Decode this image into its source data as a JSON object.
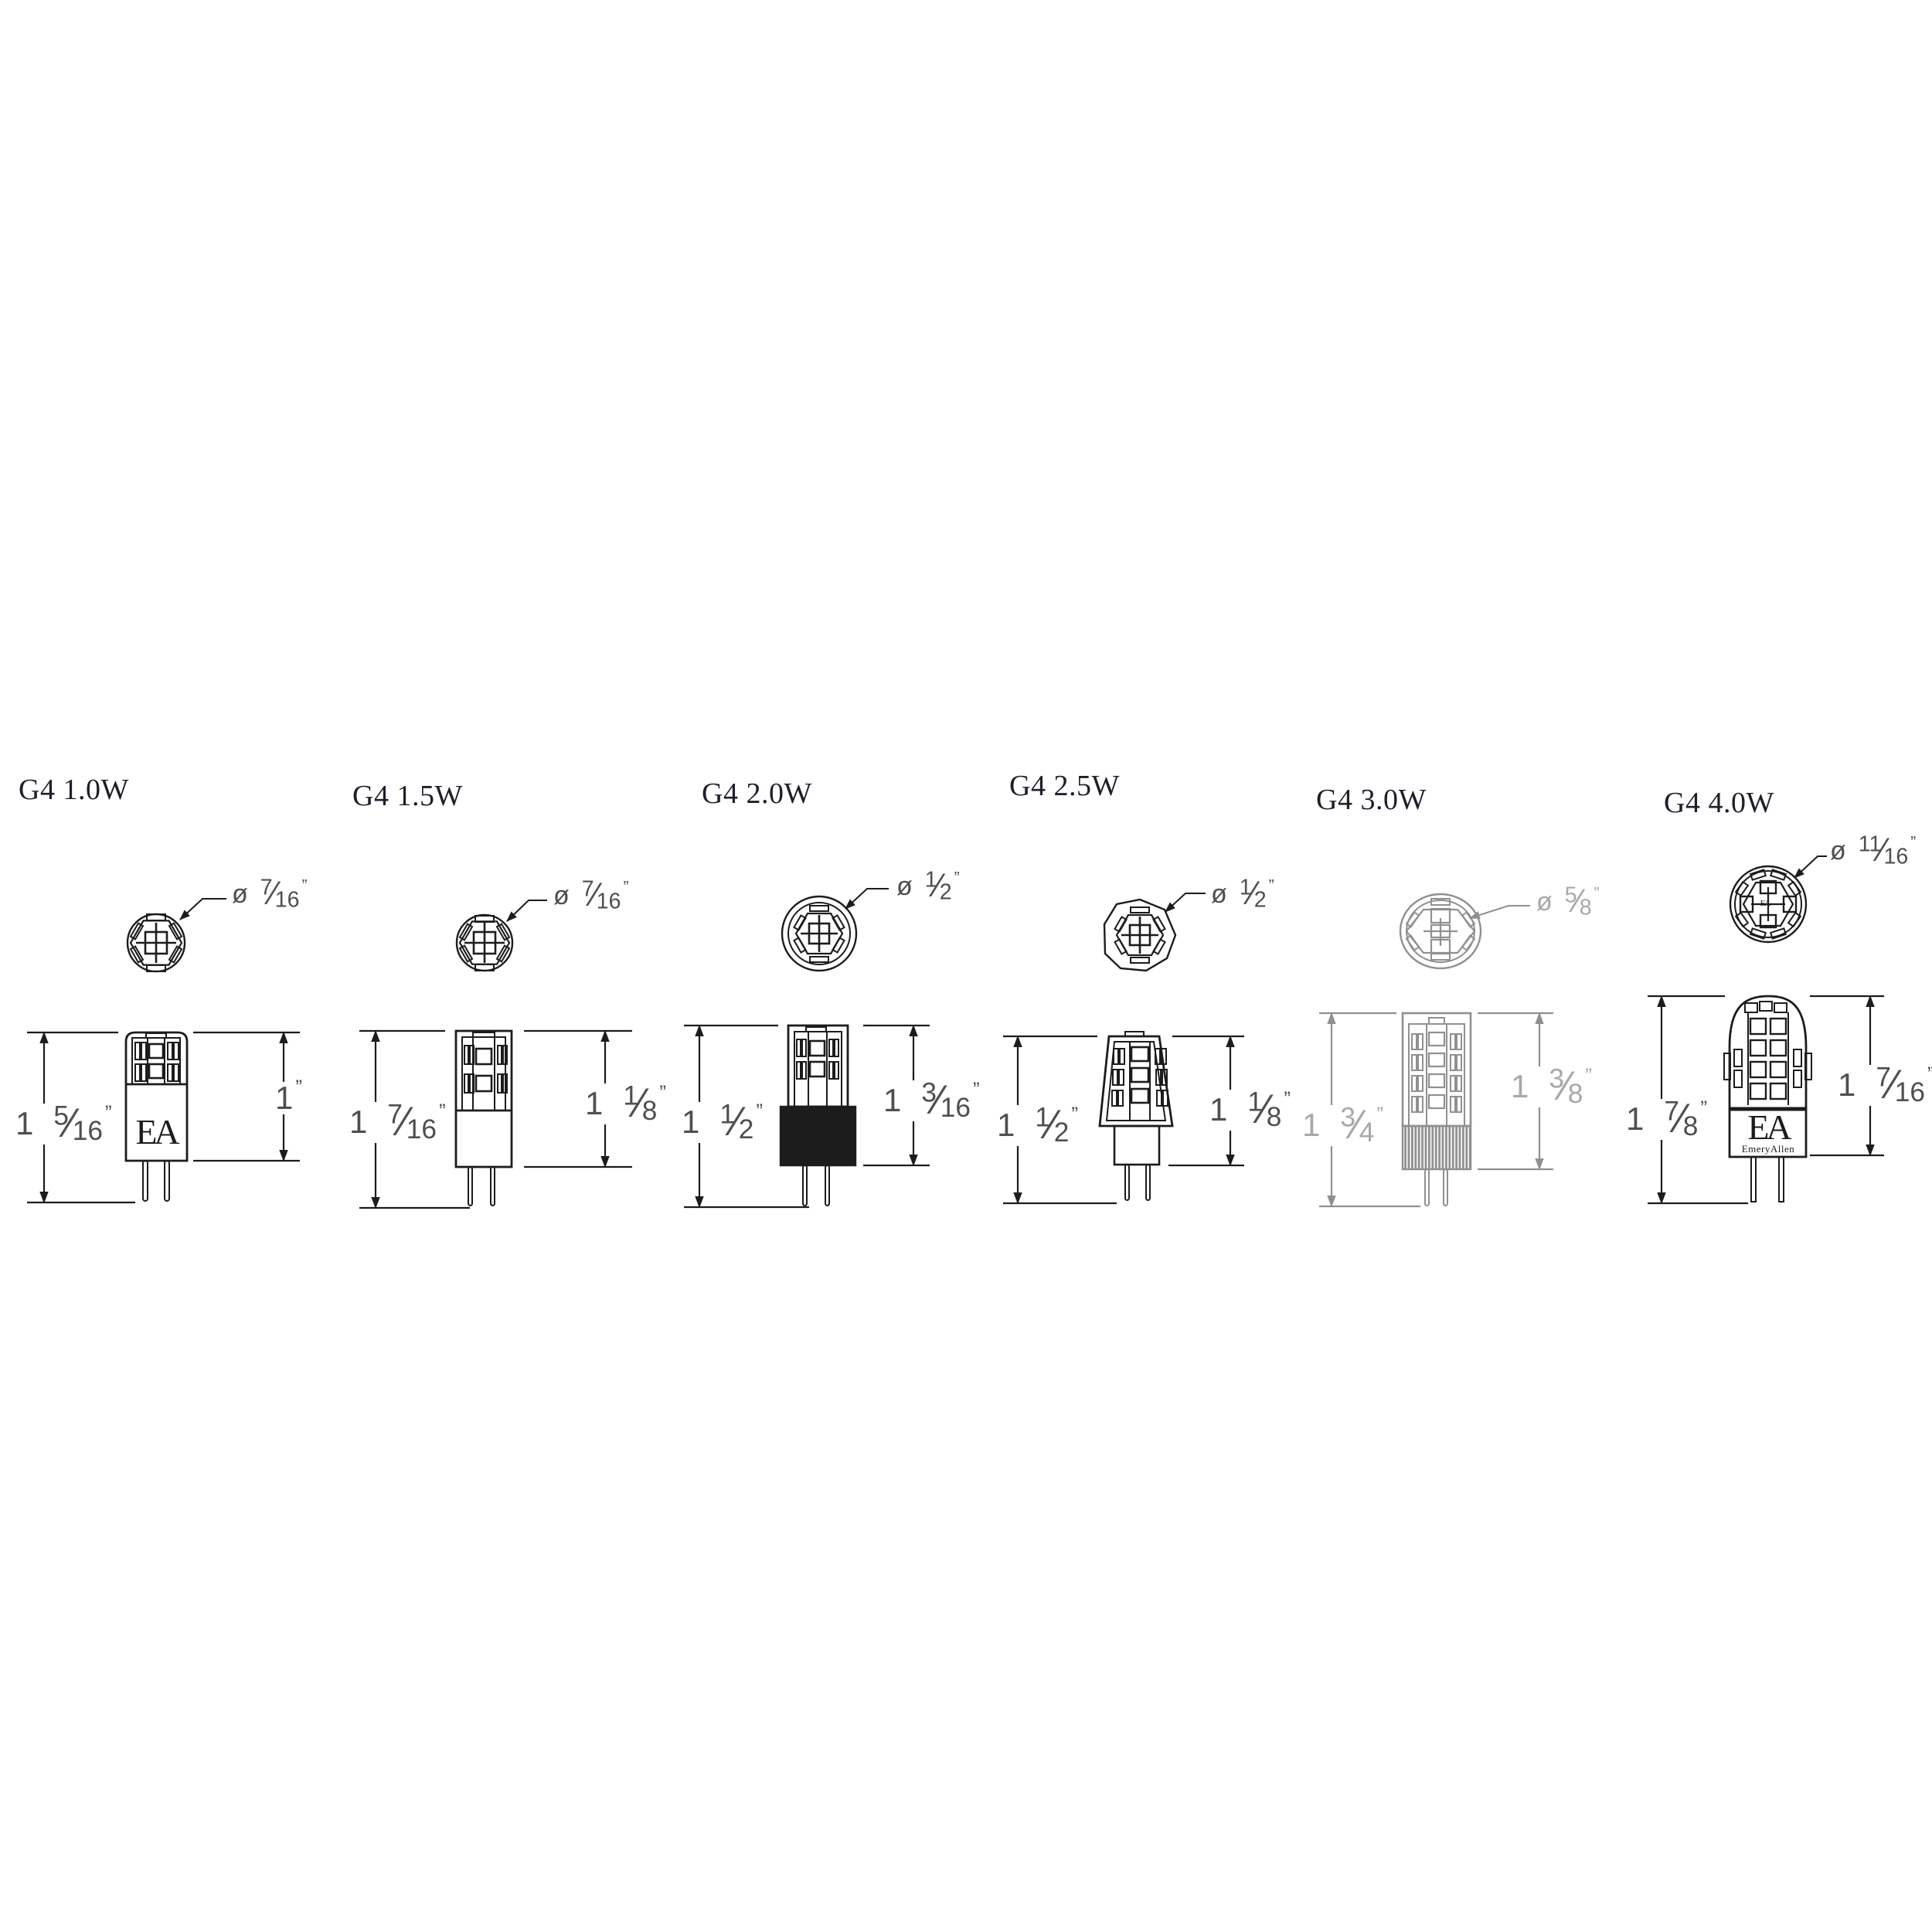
{
  "page": {
    "background": "#ffffff",
    "ink_color": "#1c1c1c",
    "muted_ink_color": "#909090",
    "label_color": "#4f4f4f",
    "title_color": "#1f1f2b"
  },
  "columns": [
    {
      "title": "G4 1.0W",
      "diameter": {
        "symbol": "ø",
        "whole": "",
        "num": "7",
        "den": "16",
        "unit": "”"
      },
      "left_dim": {
        "whole": "1",
        "num": "5",
        "den": "16",
        "unit": "”"
      },
      "right_dim": {
        "whole": "1",
        "num": "",
        "den": "",
        "unit": "”"
      },
      "logo": {
        "main": "EA",
        "sub": ""
      }
    },
    {
      "title": "G4 1.5W",
      "diameter": {
        "symbol": "ø",
        "whole": "",
        "num": "7",
        "den": "16",
        "unit": "”"
      },
      "left_dim": {
        "whole": "1",
        "num": "7",
        "den": "16",
        "unit": "”"
      },
      "right_dim": {
        "whole": "1",
        "num": "1",
        "den": "8",
        "unit": "”"
      },
      "logo": {
        "main": "",
        "sub": ""
      }
    },
    {
      "title": "G4 2.0W",
      "diameter": {
        "symbol": "ø",
        "whole": "",
        "num": "1",
        "den": "2",
        "unit": "”"
      },
      "left_dim": {
        "whole": "1",
        "num": "1",
        "den": "2",
        "unit": "”"
      },
      "right_dim": {
        "whole": "1",
        "num": "3",
        "den": "16",
        "unit": "”"
      },
      "logo": {
        "main": "",
        "sub": ""
      }
    },
    {
      "title": "G4 2.5W",
      "diameter": {
        "symbol": "ø",
        "whole": "",
        "num": "1",
        "den": "2",
        "unit": "”"
      },
      "left_dim": {
        "whole": "1",
        "num": "1",
        "den": "2",
        "unit": "”"
      },
      "right_dim": {
        "whole": "1",
        "num": "1",
        "den": "8",
        "unit": "”"
      },
      "logo": {
        "main": "",
        "sub": ""
      }
    },
    {
      "title": "G4 3.0W",
      "diameter": {
        "symbol": "ø",
        "whole": "",
        "num": "5",
        "den": "8",
        "unit": "”"
      },
      "left_dim": {
        "whole": "1",
        "num": "3",
        "den": "4",
        "unit": "”"
      },
      "right_dim": {
        "whole": "1",
        "num": "3",
        "den": "8",
        "unit": "”"
      },
      "logo": {
        "main": "",
        "sub": ""
      }
    },
    {
      "title": "G4 4.0W",
      "diameter": {
        "symbol": "ø",
        "whole": "",
        "num": "11",
        "den": "16",
        "unit": "”"
      },
      "left_dim": {
        "whole": "1",
        "num": "7",
        "den": "8",
        "unit": "”"
      },
      "right_dim": {
        "whole": "1",
        "num": "7",
        "den": "16",
        "unit": "”"
      },
      "logo": {
        "main": "EA",
        "sub": "EmeryAllen"
      }
    }
  ]
}
